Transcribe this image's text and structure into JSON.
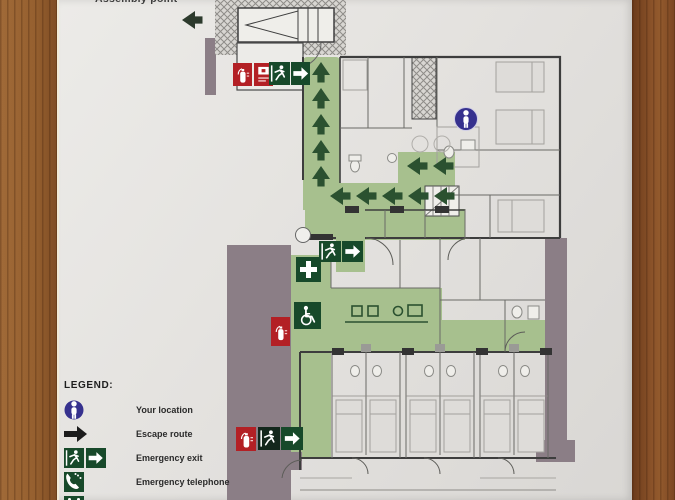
{
  "header": {
    "assembly_point_label": "Assembly point"
  },
  "legend": {
    "heading": "LEGEND:",
    "items": [
      {
        "icon": "your-location-icon",
        "label": "Your location"
      },
      {
        "icon": "escape-route-icon",
        "label": "Escape route"
      },
      {
        "icon": "emergency-exit-icon",
        "label": "Emergency exit"
      },
      {
        "icon": "emergency-telephone-icon",
        "label": "Emergency telephone"
      },
      {
        "icon": "assembly-point-icon",
        "label": "Assembly point"
      }
    ]
  },
  "plan": {
    "type": "fire-evacuation-floor-plan",
    "icons": [
      "fire-extinguisher-icon",
      "fire-alarm-call-point-icon",
      "emergency-exit-sign",
      "escape-route-arrow",
      "first-aid-icon",
      "wheelchair-refuge-icon",
      "your-location-icon",
      "assembly-point-arrow"
    ],
    "colors": {
      "escape_route_green": "#a7c08e",
      "sign_green": "#17492a",
      "arrow_green": "#2b5130",
      "corridor_grey": "#8b7e86",
      "safety_red": "#b32025",
      "location_blue": "#36318e",
      "paper": "#e6e4e1",
      "wood": "#8f5a2e"
    }
  }
}
